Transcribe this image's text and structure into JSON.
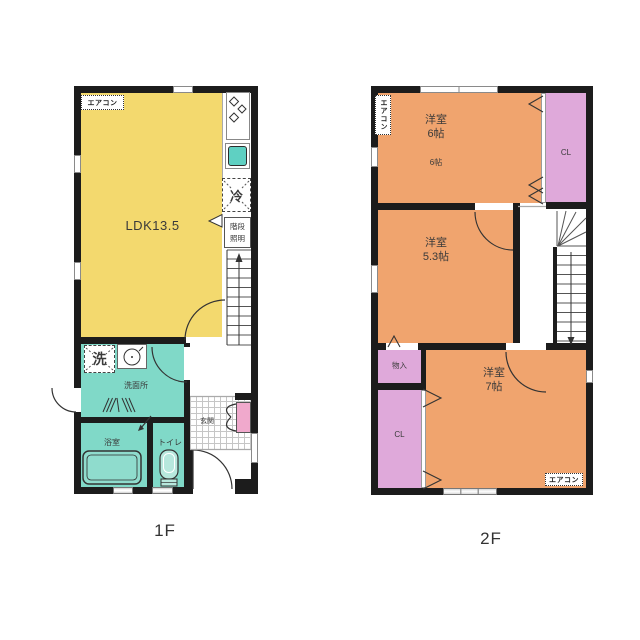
{
  "colors": {
    "wall": "#1C1C1C",
    "ldk": "#F3D96E",
    "wet": "#80D9C8",
    "room": "#F0A46E",
    "closet": "#DFA9DA",
    "cabinet": "#F0A9CC",
    "sink": "#5FD0C2",
    "tub": "#8FDCCD",
    "text": "#3A3A3A"
  },
  "floor1": {
    "floor_label": "1F",
    "aircon": "エアコン",
    "ldk": "LDK13.5",
    "fridge": "冷",
    "washer": "洗",
    "stair_light_1": "階段",
    "stair_light_2": "照明",
    "washroom": "洗面所",
    "bathroom": "浴室",
    "toilet": "トイレ",
    "entrance": "玄関"
  },
  "floor2": {
    "floor_label": "2F",
    "aircon_top": "エアコン",
    "aircon_bottom": "エアコン",
    "room6_name": "洋室",
    "room6_size": "6帖",
    "room6_sub": "6帖",
    "room53_name": "洋室",
    "room53_size": "5.3帖",
    "room7_name": "洋室",
    "room7_size": "7帖",
    "closet_top": "CL",
    "closet_bottom": "CL",
    "storage": "物入"
  }
}
